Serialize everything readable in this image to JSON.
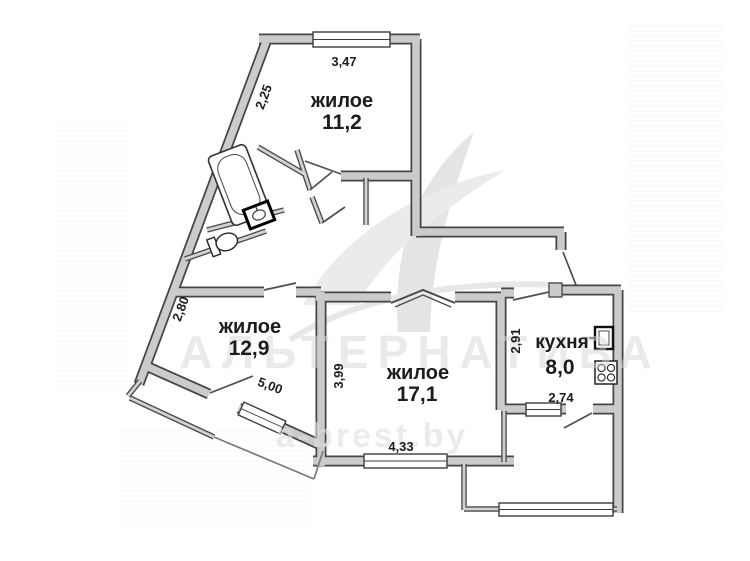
{
  "plan": {
    "title": "apartment floor plan",
    "watermark": {
      "brand": "АЛЬТЕРНАТИВА",
      "site": "a-brest.by"
    },
    "rooms": [
      {
        "name": "жилое",
        "area": "11,2",
        "dim_width": "3,47",
        "dim_side": "2,25"
      },
      {
        "name": "жилое",
        "area": "12,9",
        "dim_side": "2,80",
        "dim_window": "5,00"
      },
      {
        "name": "жилое",
        "area": "17,1",
        "dim_side": "3,99",
        "dim_width": "4,33"
      },
      {
        "name": "кухня",
        "area": "8,0",
        "dim_side": "2,91",
        "dim_width": "2,74"
      }
    ],
    "fixtures": [
      "bathtub",
      "bath-sink",
      "toilet",
      "kitchen-sink",
      "stove"
    ],
    "colors": {
      "wall_fill": "#cbcbcb",
      "wall_edge": "#454545",
      "watermark": "#d6d6d6"
    }
  }
}
